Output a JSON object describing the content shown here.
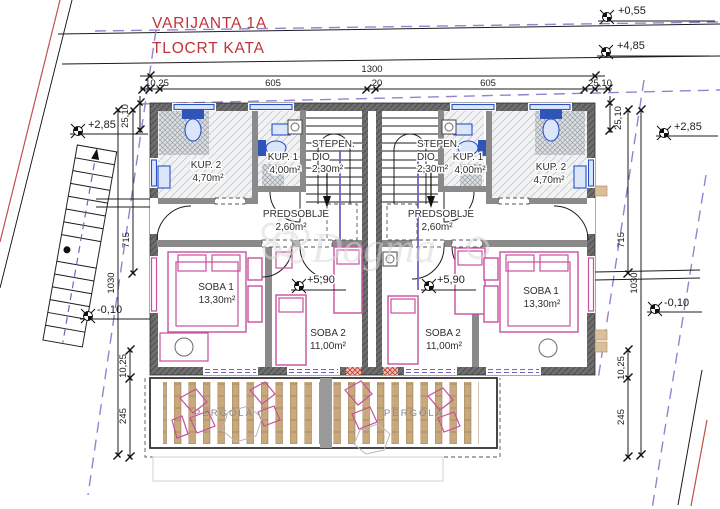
{
  "title": {
    "line1": "VARIJANTA 1A",
    "line2": "TLOCRT KATA"
  },
  "watermark": {
    "text": "Dogma"
  },
  "levels": {
    "plus055": "+0,55",
    "plus485": "+4,85",
    "plus285_left": "+2,85",
    "plus285_right": "+2,85",
    "minus010_left": "-0,10",
    "minus010_right": "-0,10",
    "plus590_left": "+5,90",
    "plus590_right": "+5,90"
  },
  "dimensions": {
    "total_width": "1300",
    "seg1": "10,25",
    "seg2": "605",
    "seg3": "20",
    "seg4": "605",
    "seg5": "25,10",
    "corner_left": "25,10",
    "corner_right": "25,10",
    "left": {
      "d715": "715",
      "d1030": "1030",
      "d1025": "10,25",
      "d245": "245"
    },
    "right": {
      "d715": "715",
      "d1030": "1030",
      "d1025": "10,25",
      "d245": "245"
    }
  },
  "rooms": {
    "left": {
      "kup2": {
        "name": "KUP. 2",
        "area": "4,70m²"
      },
      "kup1": {
        "name": "KUP. 1",
        "area": "4,00m²"
      },
      "stepen": {
        "line1": "STEPEN.",
        "line2": "DIO",
        "area": "2,30m²"
      },
      "predsoblje": {
        "name": "PREDSOBLJE",
        "area": "2,60m²"
      },
      "soba1": {
        "name": "SOBA 1",
        "area": "13,30m²"
      },
      "soba2": {
        "name": "SOBA 2",
        "area": "11,00m²"
      },
      "pergola": {
        "name": "PERGOLA"
      }
    },
    "right": {
      "kup1": {
        "name": "KUP. 1",
        "area": "4,00m²"
      },
      "kup2": {
        "name": "KUP. 2",
        "area": "4,70m²"
      },
      "stepen": {
        "line1": "STEPEN.",
        "line2": "DIO",
        "area": "2,30m²"
      },
      "predsoblje": {
        "name": "PREDSOBLJE",
        "area": "2,60m²"
      },
      "soba1": {
        "name": "SOBA 1",
        "area": "13,30m²"
      },
      "soba2": {
        "name": "SOBA 2",
        "area": "11,00m²"
      },
      "pergola": {
        "name": "PERGOLA"
      }
    }
  }
}
